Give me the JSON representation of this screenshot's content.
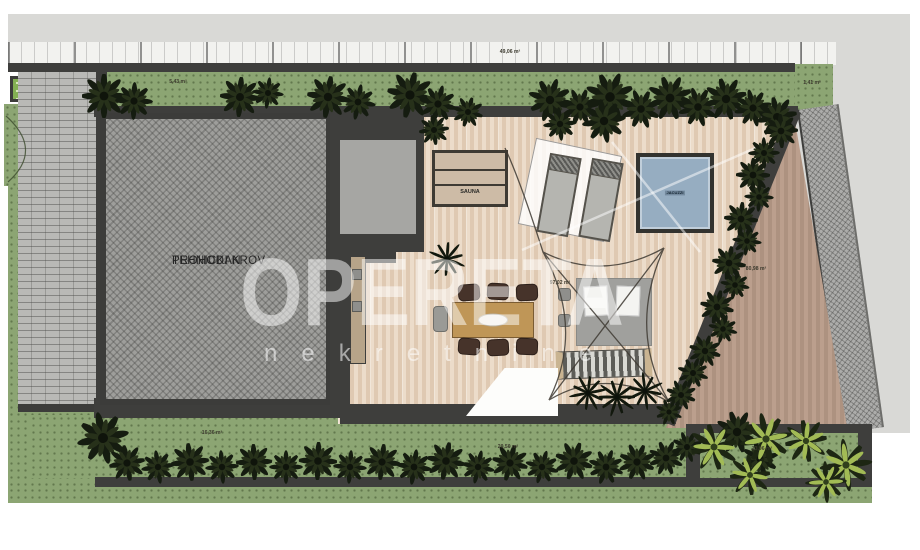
{
  "watermark": {
    "title": "OPERETA",
    "subtitle": "nekretnine"
  },
  "plan": {
    "technical_roof": {
      "line1": "TEHNICKI KROV",
      "line2": "PROHODAN"
    },
    "sauna": {
      "label": "SAUNA"
    },
    "pool": {
      "label": "JACUZZI"
    },
    "area_labels": {
      "top_left": "5,43 m²",
      "top_center": "49,06 m²",
      "top_right": "1,41 m²",
      "deck": "97,02 m²",
      "east_deck": "80,98 m²",
      "garden_south_left": "16,36 m²",
      "garden_south_center": "20,50 m²",
      "garden_southeast": "13,96 m²"
    },
    "colors": {
      "deck_wood": "#e5d1bb",
      "east_deck_wood": "#b49a88",
      "pool_water": "#96adc1",
      "grass": "#8ca573",
      "wall": "#3e3e3c",
      "roof_hatch": "#9e9e9b",
      "watermark": "#ffffff"
    }
  }
}
